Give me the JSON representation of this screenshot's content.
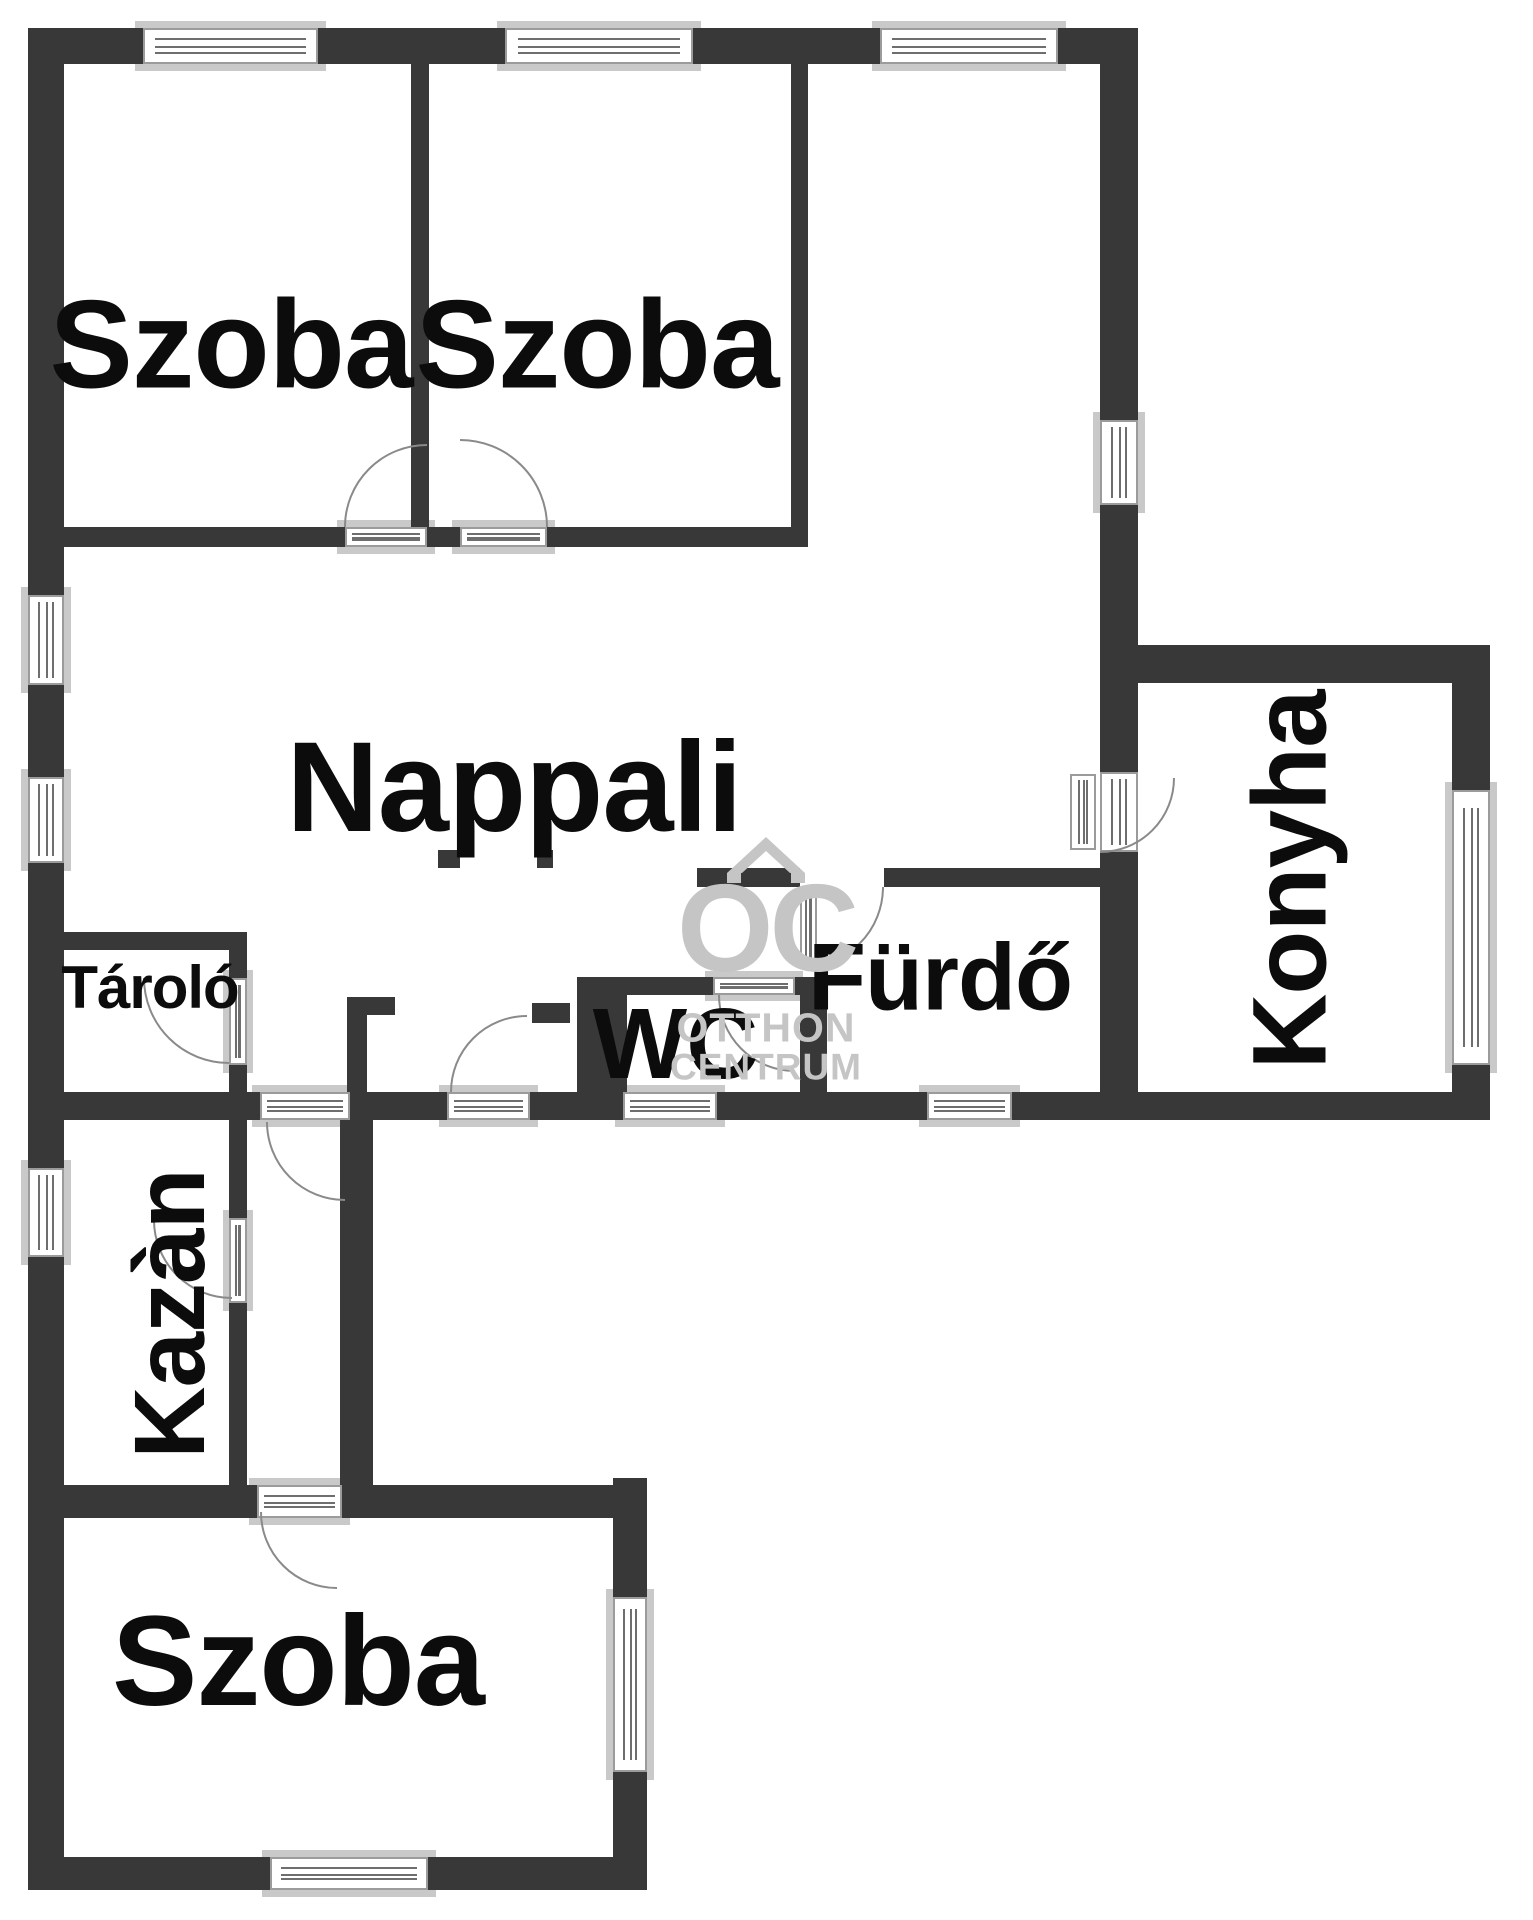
{
  "rooms": {
    "szoba_top_left": "Szoba",
    "szoba_top_mid": "Szoba",
    "nappali": "Nappali",
    "tarolo": "Tároló",
    "wc": "WC",
    "furdo": "Fürdő",
    "konyha": "Konyha",
    "kazan": "Kazàn",
    "szoba_bottom": "Szoba"
  },
  "watermark": {
    "monogram": "OC",
    "line1": "OTTHON",
    "line2": "CENTRUM"
  },
  "colors": {
    "wall": "#383838",
    "frame": "#9b9b9b",
    "sill": "#c9c9c9",
    "arc": "#8a8a8a",
    "label": "#0c0c0c",
    "wm": "#c5c5c5",
    "bg": "#ffffff"
  }
}
